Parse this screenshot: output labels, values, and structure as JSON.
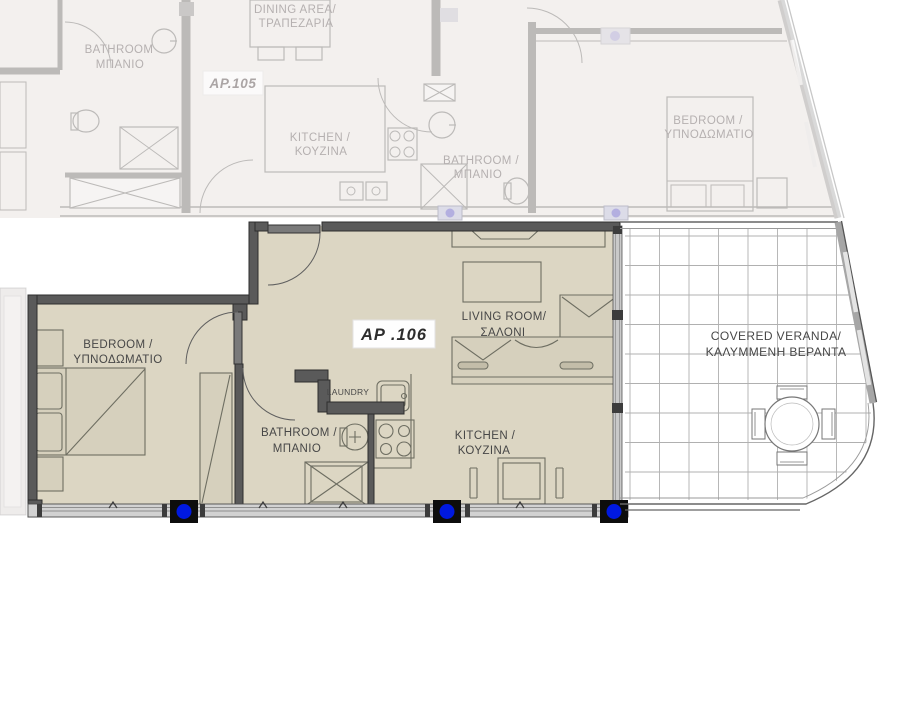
{
  "units": {
    "ap106": {
      "label": "AP .106",
      "bedroom_l1": "BEDROOM /",
      "bedroom_l2": "ΥΠΝΟΔΩΜΑΤΙΟ",
      "bathroom_l1": "BATHROOM /",
      "bathroom_l2": "ΜΠΑΝΙΟ",
      "laundry": "LAUNDRY",
      "living_l1": "LIVING ROOM/",
      "living_l2": "ΣΑΛΟΝΙ",
      "kitchen_l1": "KITCHEN /",
      "kitchen_l2": "ΚΟΥΖΙΝΑ",
      "veranda_l1": "COVERED VERANDA/",
      "veranda_l2": "ΚΑΛΥΜΜΕΝΗ ΒΕΡΑΝΤΑ"
    },
    "ap105": {
      "label": "AP.105",
      "bathroom_left_l1": "BATHROOM",
      "bathroom_left_l2": "ΜΠΑΝΙΟ",
      "dining_l1": "DINING AREA/",
      "dining_l2": "ΤΡΑΠΕΖΑΡΙΑ",
      "kitchen_l1": "KITCHEN /",
      "kitchen_l2": "ΚΟΥΖΙΝΑ",
      "bathroom_right_l1": "BATHROOM /",
      "bathroom_right_l2": "ΜΠΑΝΙΟ",
      "bedroom_l1": "BEDROOM /",
      "bedroom_l2": "ΥΠΝΟΔΩΜΑΤΙΟ"
    }
  },
  "colors": {
    "background": "#ffffff",
    "floor": "#dcd6c3",
    "faded_floor": "#f3f0ee",
    "wall": "#4f4f4f",
    "window_band": "#cccccc",
    "furniture_outline": "#6e6e62",
    "label_text": "#474747",
    "faded_text": "#b5b0b0",
    "column_marker_blue": "#0019e0",
    "column_marker_block": "#0d0d0d",
    "veranda_grid": "#b0b0b0"
  }
}
